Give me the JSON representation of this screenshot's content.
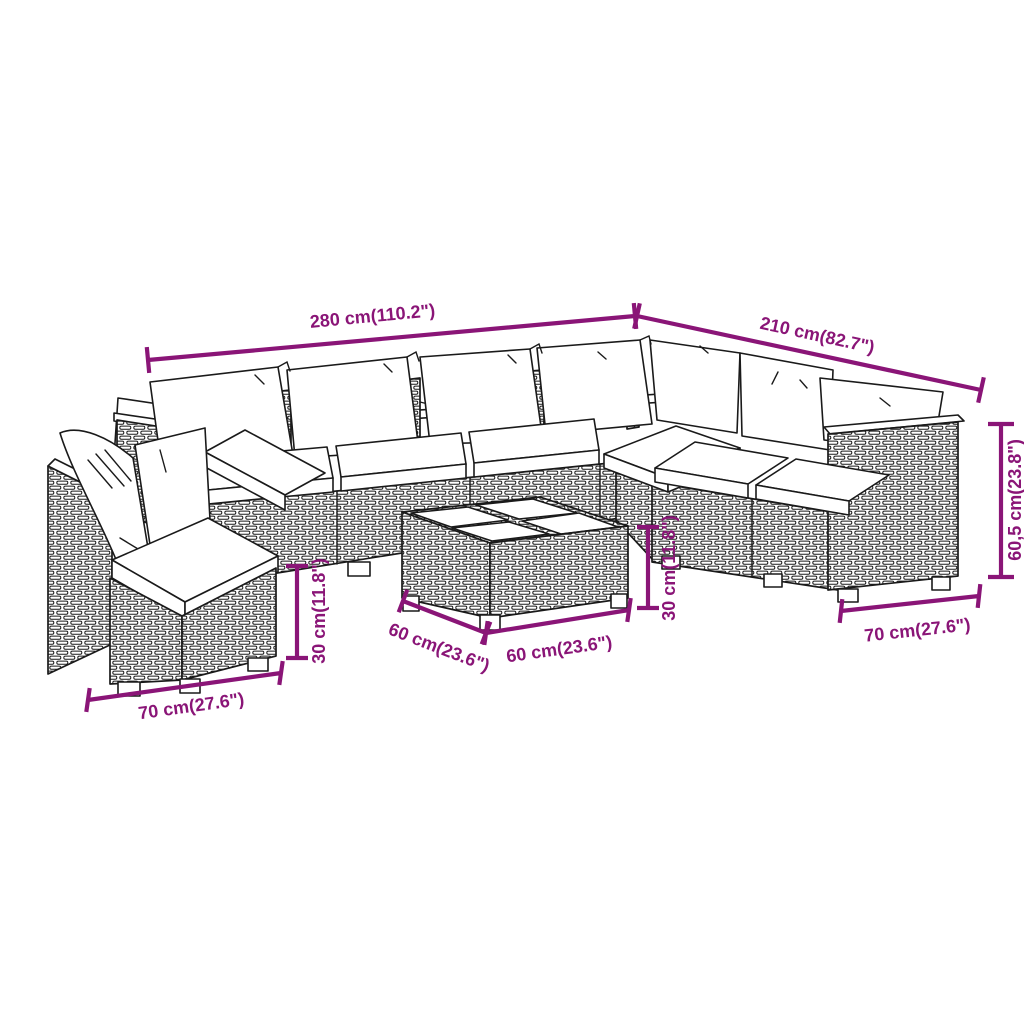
{
  "diagram": {
    "type": "furniture-dimension-diagram",
    "subject": "rattan garden lounge set with cushions and coffee table",
    "background_color": "#ffffff",
    "line_art_color": "#1a1a1a",
    "dimension_color": "#8a1577",
    "dimensions": {
      "back_width": {
        "label": "280 cm(110.2\")"
      },
      "side_width": {
        "label": "210 cm(82.7\")"
      },
      "total_height": {
        "label": "60,5 cm(23.8\")"
      },
      "right_module_width": {
        "label": "70 cm(27.6\")"
      },
      "table_height": {
        "label": "30 cm(11.8\")"
      },
      "table_depth": {
        "label": "60 cm(23.6\")"
      },
      "table_width": {
        "label": "60 cm(23.6\")"
      },
      "seat_height": {
        "label": "30 cm(11.8\")"
      },
      "left_module_width": {
        "label": "70 cm(27.6\")"
      }
    },
    "parts": [
      "sectional sofa",
      "corner sofa module",
      "coffee table",
      "back pillows",
      "seat cushions"
    ]
  }
}
